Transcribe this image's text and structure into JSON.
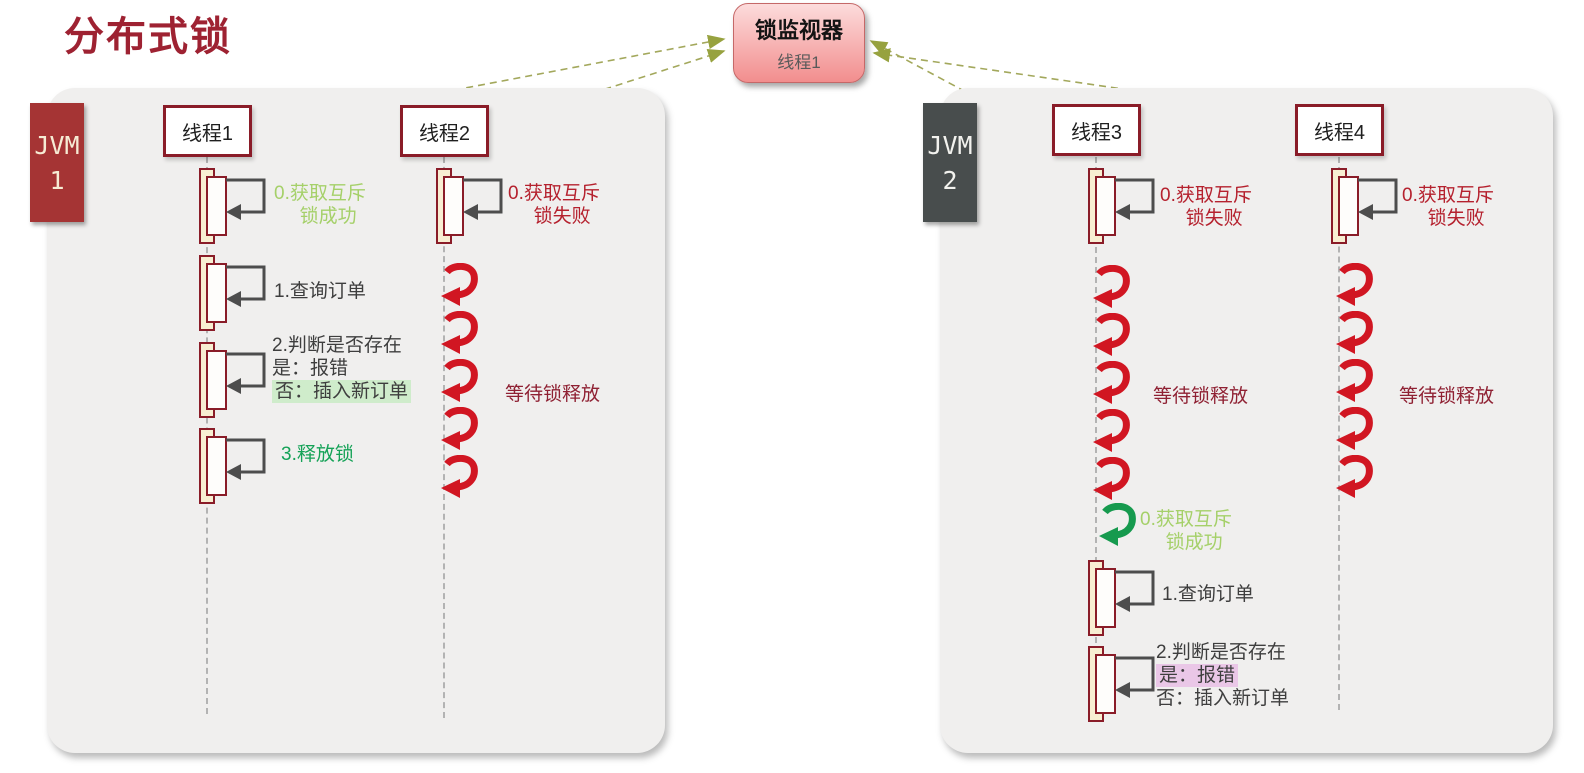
{
  "title": "分布式锁",
  "monitor": {
    "title": "锁监视器",
    "subtitle": "线程1"
  },
  "jvm1": {
    "line1": "JVM",
    "line2": "1"
  },
  "jvm2": {
    "line1": "JVM",
    "line2": "2"
  },
  "thread1": {
    "name": "线程1",
    "acquire_line1": "0.获取互斥",
    "acquire_line2": "锁成功",
    "step1": "1.查询订单",
    "step2_title": "2.判断是否存在",
    "step2_yes": "是：报错",
    "step2_no": "否：插入新订单",
    "step3": "3.释放锁"
  },
  "thread2": {
    "name": "线程2",
    "fail_line1": "0.获取互斥",
    "fail_line2": "锁失败",
    "wait_label": "等待锁释放",
    "wait_loops": 5
  },
  "thread3": {
    "name": "线程3",
    "fail_line1": "0.获取互斥",
    "fail_line2": "锁失败",
    "wait_label": "等待锁释放",
    "wait_loops": 5,
    "success_loops": 1,
    "success_line1": "0.获取互斥",
    "success_line2": "锁成功",
    "step1": "1.查询订单",
    "step2_title": "2.判断是否存在",
    "step2_yes": "是：报错",
    "step2_no": "否：插入新订单"
  },
  "thread4": {
    "name": "线程4",
    "fail_line1": "0.获取互斥",
    "fail_line2": "锁失败",
    "wait_label": "等待锁释放",
    "wait_loops": 5
  },
  "colors": {
    "title_red": "#9e2232",
    "jvm1_bg": "#a53434",
    "jvm2_bg": "#484d4d",
    "box_border": "#8a1c28",
    "monitor_top": "#fcdcdc",
    "monitor_bottom": "#f28e8e",
    "success_green_light": "#a5d069",
    "release_green": "#15a257",
    "fail_red": "#b5212e",
    "wait_maroon": "#8f2133",
    "spiral_red": "#d11622",
    "spiral_green": "#169a4e",
    "highlight_green": "#cfeccb",
    "highlight_pink": "#eac7e7",
    "connector_olive": "#a3a85c",
    "arrow_gray": "#4d4d4d"
  }
}
